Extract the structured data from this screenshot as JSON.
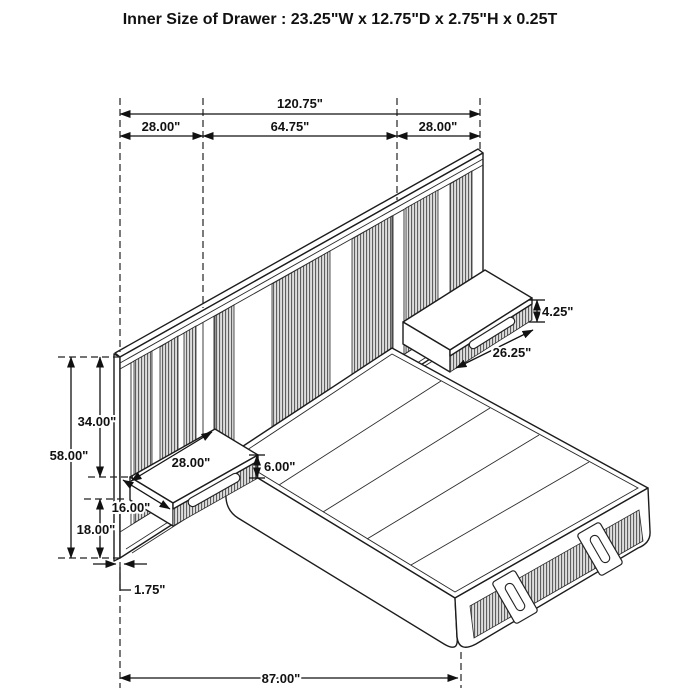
{
  "title": "Inner Size of Drawer : 23.25\"W x 12.75\"D x 2.75\"H x 0.25T",
  "dimensions": {
    "overall_width": "120.75\"",
    "left_section": "28.00\"",
    "center_section": "64.75\"",
    "right_section": "28.00\"",
    "headboard_height": "58.00\"",
    "top_to_nightstand": "34.00\"",
    "nightstand_to_floor": "18.00\"",
    "nightstand_width": "28.00\"",
    "nightstand_depth": "16.00\"",
    "nightstand_height": "6.00\"",
    "right_nightstand_height": "4.25\"",
    "right_nightstand_width": "26.25\"",
    "headboard_thickness": "1.75\"",
    "bed_depth": "87.00\""
  }
}
